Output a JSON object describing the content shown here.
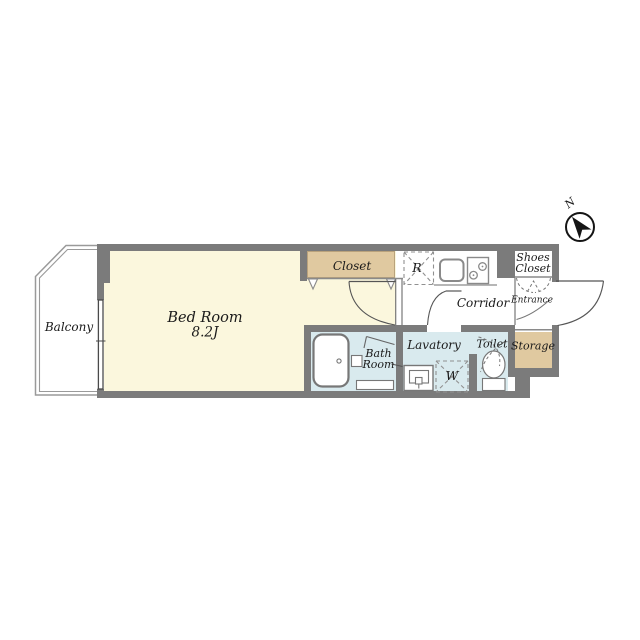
{
  "compass": {
    "north_label": "N"
  },
  "rooms": {
    "balcony": {
      "label": "Balcony"
    },
    "bedroom": {
      "label": "Bed Room",
      "size": "8.2J"
    },
    "closet": {
      "label": "Closet"
    },
    "refrigerator": {
      "label": "R"
    },
    "corridor": {
      "label": "Corridor"
    },
    "shoes_closet": {
      "label_line1": "Shoes",
      "label_line2": "Closet"
    },
    "entrance": {
      "label": "Entrance"
    },
    "storage": {
      "label": "Storage"
    },
    "bath": {
      "label_line1": "Bath",
      "label_line2": "Room"
    },
    "lavatory": {
      "label": "Lavatory"
    },
    "washer": {
      "label": "W"
    },
    "toilet": {
      "label": "Toilet"
    }
  },
  "colors": {
    "wall": "#7b7b7b",
    "bedroom": "#fbf7dd",
    "closet": "#e0c9a0",
    "wet": "#d9eaee",
    "outline": "#9a9a9a"
  }
}
